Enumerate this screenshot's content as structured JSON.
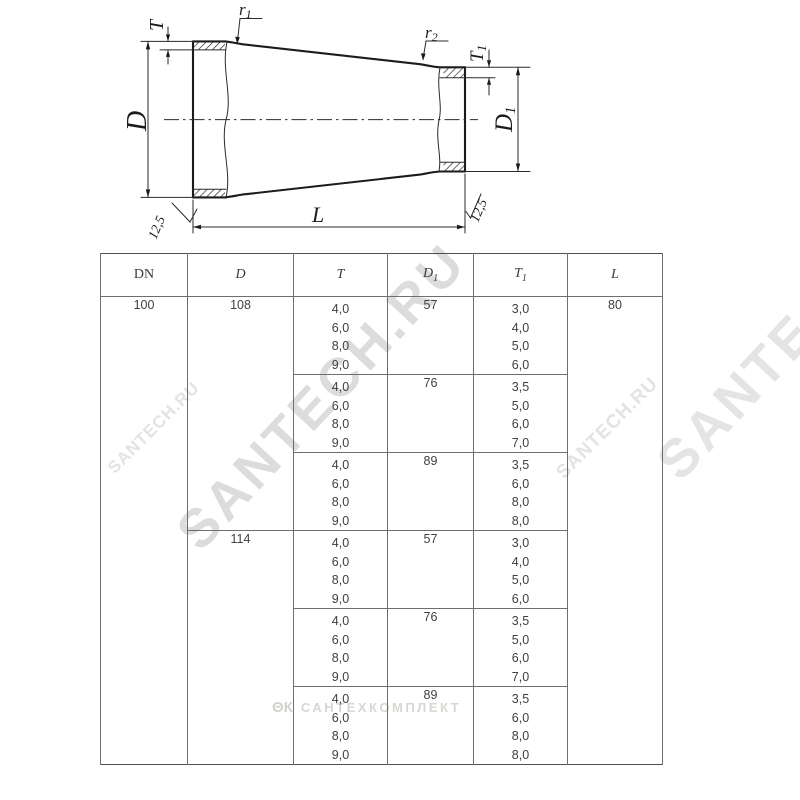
{
  "drawing": {
    "labels": {
      "t_main": "T",
      "t1_main": "T",
      "t1_sub": "1",
      "d_main": "D",
      "d1_main": "D",
      "d1_sub": "1",
      "r1_main": "r",
      "r1_sub": "1",
      "r2_main": "r",
      "r2_sub": "2",
      "l": "L",
      "roughness_left": "12,5",
      "roughness_right": "12,5"
    },
    "line_color": "#1c1c1c"
  },
  "table": {
    "headers": {
      "dn": "DN",
      "d": "D",
      "t": "T",
      "d1_main": "D",
      "d1_sub": "1",
      "t1_main": "T",
      "t1_sub": "1",
      "l": "L"
    },
    "dn": "100",
    "l": "80",
    "groups": [
      {
        "d": "108",
        "sub": [
          {
            "t": [
              "4,0",
              "6,0",
              "8,0",
              "9,0"
            ],
            "d1": "57",
            "t1": [
              "3,0",
              "4,0",
              "5,0",
              "6,0"
            ]
          },
          {
            "t": [
              "4,0",
              "6,0",
              "8,0",
              "9,0"
            ],
            "d1": "76",
            "t1": [
              "3,5",
              "5,0",
              "6,0",
              "7,0"
            ]
          },
          {
            "t": [
              "4,0",
              "6,0",
              "8,0",
              "9,0"
            ],
            "d1": "89",
            "t1": [
              "3,5",
              "6,0",
              "8,0",
              "8,0"
            ]
          }
        ]
      },
      {
        "d": "114",
        "sub": [
          {
            "t": [
              "4,0",
              "6,0",
              "8,0",
              "9,0"
            ],
            "d1": "57",
            "t1": [
              "3,0",
              "4,0",
              "5,0",
              "6,0"
            ]
          },
          {
            "t": [
              "4,0",
              "6,0",
              "8,0",
              "9,0"
            ],
            "d1": "76",
            "t1": [
              "3,5",
              "5,0",
              "6,0",
              "7,0"
            ]
          },
          {
            "t": [
              "4,0",
              "6,0",
              "8,0",
              "9,0"
            ],
            "d1": "89",
            "t1": [
              "3,5",
              "6,0",
              "8,0",
              "8,0"
            ]
          }
        ]
      }
    ]
  },
  "watermarks": {
    "diagonal_main": "SANTECH.RU",
    "diagonal_top_right": "SANTECH.RU",
    "diagonal_left": "SANTECH.RU",
    "diagonal_right": "SANTECH.RU",
    "bottom_logo": "ΘК",
    "bottom_text": "САНТЕХКОМПЛЕКТ",
    "color": "#dcdcdc"
  }
}
